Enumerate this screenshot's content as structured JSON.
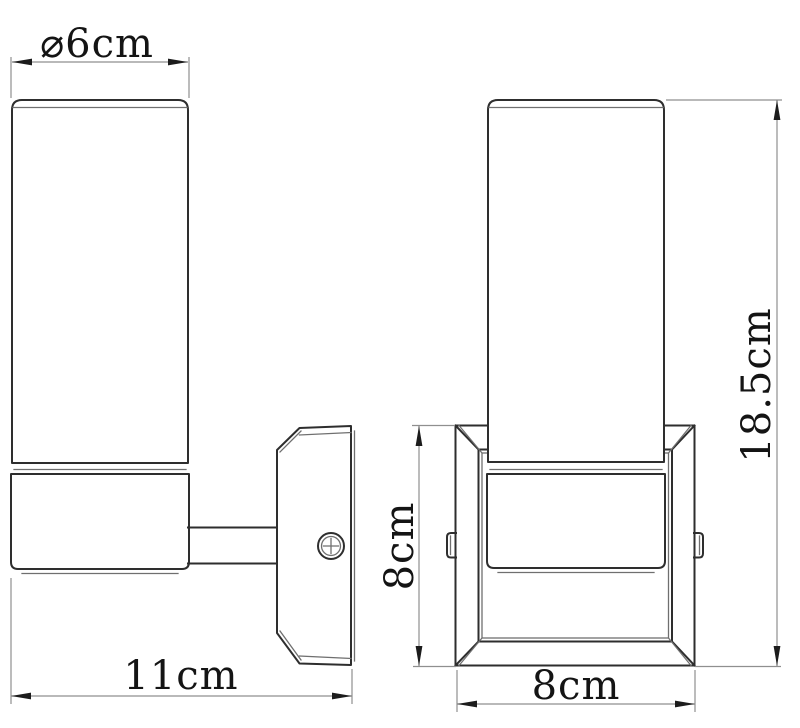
{
  "colors": {
    "background": "#ffffff",
    "object_line": "#2e2e2e",
    "detail_line": "#6f6f6f",
    "dimension_line": "#8f8f8f",
    "arrow_fill": "#1c1c1c",
    "text": "#141414"
  },
  "dimensions": {
    "diameter": {
      "label": "⌀6cm"
    },
    "total_width": {
      "label": "11cm"
    },
    "backplate_height": {
      "label": "8cm"
    },
    "backplate_width": {
      "label": "8cm"
    },
    "total_height": {
      "label": "18.5cm"
    }
  }
}
